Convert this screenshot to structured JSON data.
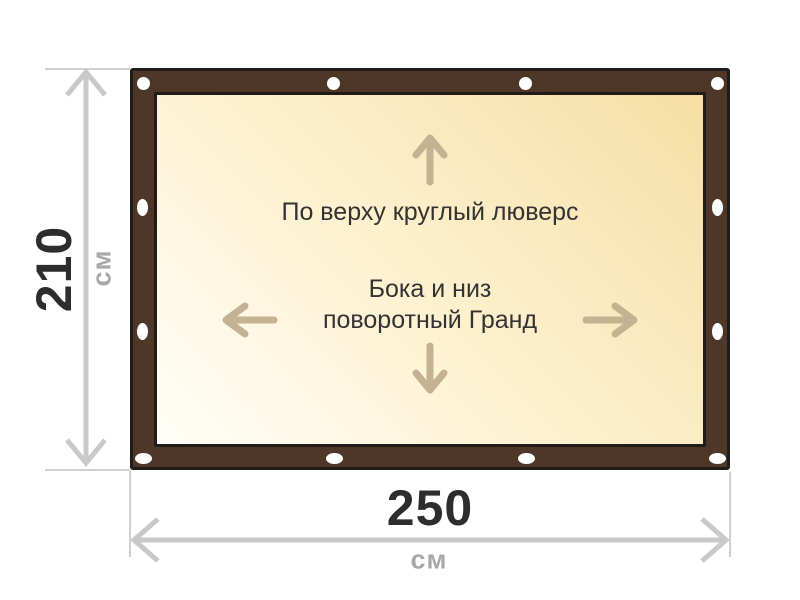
{
  "diagram": {
    "panel": {
      "top_note": "По верху круглый люверс",
      "middle_note_line1": "Бока и низ",
      "middle_note_line2": "поворотный Гранд"
    },
    "dimensions": {
      "height": {
        "value": "210",
        "unit": "см"
      },
      "width": {
        "value": "250",
        "unit": "см"
      }
    },
    "frame": {
      "grommet_count": 12
    }
  },
  "colors": {
    "frame_brown": "#4e3726",
    "outline": "#211c17",
    "canvas_light": "#fffef8",
    "canvas_mid": "#fdf0cd",
    "canvas_deep": "#f6dfa6",
    "arrow_tan": "#c4b292",
    "dim_gray": "#c9c9c9",
    "ext_gray": "#d0d0d0",
    "num_dark": "#2d2d2d",
    "unit_gray": "#a8a8a8",
    "text_dark": "#333333",
    "grommet_white": "#ffffff"
  }
}
